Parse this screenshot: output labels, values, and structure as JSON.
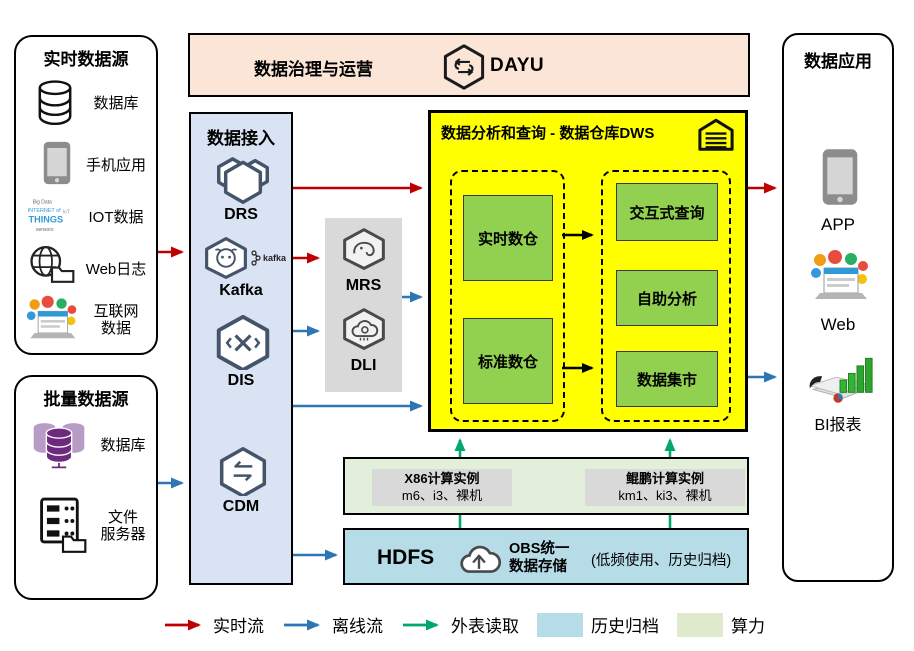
{
  "governance": {
    "title": "数据治理与运营",
    "logo": "DAYU"
  },
  "realtime_sources": {
    "title": "实时数据源",
    "items": [
      {
        "label": "数据库",
        "icon": "database-icon"
      },
      {
        "label": "手机应用",
        "icon": "mobile-phone-icon"
      },
      {
        "label": "IOT数据",
        "icon": "iot-wordcloud-icon"
      },
      {
        "label": "Web日志",
        "icon": "globe-folder-icon"
      },
      {
        "label": "互联网数据",
        "lines": [
          "互联网",
          "数据"
        ],
        "icon": "internet-collage-icon"
      }
    ]
  },
  "batch_sources": {
    "title": "批量数据源",
    "items": [
      {
        "label": "数据库",
        "icon": "purple-database-icon"
      },
      {
        "label": "文件服务器",
        "lines": [
          "文件",
          "服务器"
        ],
        "icon": "file-server-icon"
      }
    ]
  },
  "ingestion": {
    "title": "数据接入",
    "items": [
      {
        "label": "DRS"
      },
      {
        "label": "Kafka",
        "badge": "kafka"
      },
      {
        "label": "DIS"
      },
      {
        "label": "CDM"
      }
    ]
  },
  "processing": {
    "items": [
      {
        "label": "MRS"
      },
      {
        "label": "DLI"
      }
    ]
  },
  "dws": {
    "title": "数据分析和查询 - 数据仓库DWS",
    "warehouses": [
      "实时数仓",
      "标准数仓"
    ],
    "services": [
      "交互式查询",
      "自助分析",
      "数据集市"
    ]
  },
  "compute": {
    "instances": [
      {
        "title": "X86计算实例",
        "subtitle": "m6、i3、裸机"
      },
      {
        "title": "鲲鹏计算实例",
        "subtitle": "km1、ki3、裸机"
      }
    ]
  },
  "storage": {
    "hdfs": "HDFS",
    "obs_line1": "OBS统一",
    "obs_line2": "数据存储",
    "note": "(低频使用、历史归档)"
  },
  "apps": {
    "title": "数据应用",
    "items": [
      {
        "label": "APP"
      },
      {
        "label": "Web"
      },
      {
        "label": "BI报表"
      }
    ]
  },
  "legend": {
    "items": [
      {
        "label": "实时流",
        "swatch": "arrow",
        "color": "#c00000"
      },
      {
        "label": "离线流",
        "swatch": "arrow",
        "color": "#2e75b6"
      },
      {
        "label": "外表读取",
        "swatch": "arrow",
        "color": "#00a86b"
      },
      {
        "label": "历史归档",
        "swatch": "box",
        "color": "#b6dce8"
      },
      {
        "label": "算力",
        "swatch": "box",
        "color": "#dfeacd"
      }
    ]
  },
  "colors": {
    "realtime_flow": "#c00000",
    "offline_flow": "#2e75b6",
    "external_read": "#00a86b",
    "dws_bg": "#ffff00",
    "dws_node": "#92d050",
    "ingestion_bg": "#dae3f3",
    "governance_bg": "#fbe5d6",
    "processing_bg": "#d9d9d9",
    "compute_bg": "#e2efda",
    "storage_bg": "#b6dce8"
  }
}
